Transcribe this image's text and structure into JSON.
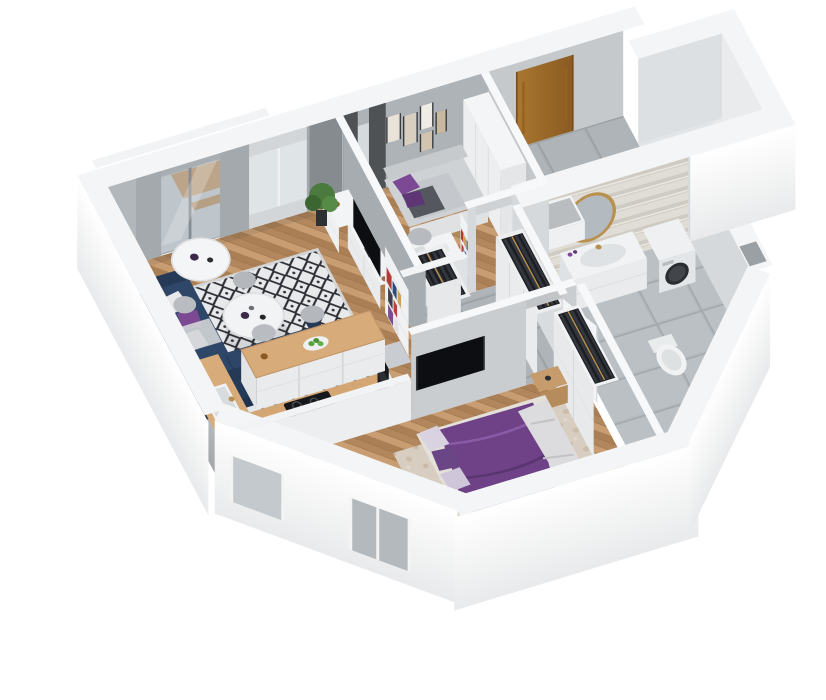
{
  "meta": {
    "title": "3D apartment floor plan - isometric cutaway render",
    "render_type": "dollhouse-cutaway",
    "background": "#ffffff"
  },
  "colors": {
    "wall-outer": "#fbfcfc",
    "wall-band": "#f4f5f6",
    "wall-gray": "#b2b7bb",
    "wall-gray-dark": "#9aa0a4",
    "wall-white": "#dcdfe1",
    "floor-wood": "#c0946a",
    "floor-wood-dark": "#ab7f55",
    "tile-blue": "#46587a",
    "tile-bg": "#e3e7ea",
    "tile-gray": "#a9afb3",
    "sofa-navy": "#2e4668",
    "sofa-navy-dark": "#253a57",
    "accent-purple": "#7c4a94",
    "accent-purple-dark": "#5e3575",
    "bed-purple": "#6f4288",
    "rug-light": "#e8e9ea",
    "rug-diamond": "#2b2e34",
    "rug-beige": "#d8cdc1",
    "door-wood": "#a9772f",
    "door-wood-dark": "#8a5a22",
    "gold": "#b8914f",
    "tv-black": "#0d0e11",
    "appliance-black": "#17181b",
    "plant-green": "#4a7a3d",
    "clothes-dark": "#23262c",
    "chevron-a": "#d8d3ca",
    "chevron-b": "#e9e6e0",
    "curtain-gray": "#868b8f",
    "curtain-dark": "#4e5255",
    "glass": "#ccd4da"
  },
  "scene": {
    "rooms": [
      {
        "name": "living-room",
        "floor": "wood-parquet",
        "furniture": [
          "corner-sofa-navy",
          "coffee-table-round",
          "dining-table-round",
          "dining-chairs",
          "rug-diamond-pattern",
          "tv-console",
          "tv",
          "bookshelf",
          "sideboard",
          "balcony-door",
          "gray-curtains",
          "plant"
        ]
      },
      {
        "name": "kitchen",
        "floor": "patterned-tile",
        "furniture": [
          "u-shaped-counter",
          "sink",
          "cooktop",
          "oven-column",
          "bar-chairs",
          "fruit-bowl",
          "half-wall"
        ]
      },
      {
        "name": "office-guest-room",
        "floor": "wood-parquet",
        "furniture": [
          "daybed-purple-pillows",
          "desk",
          "desk-chair",
          "ladder-shelf",
          "wardrobe-white",
          "gallery-wall-frames",
          "dark-curtains"
        ]
      },
      {
        "name": "entrance-hall",
        "floor": "gray-tile",
        "furniture": [
          "front-door-wood",
          "bench-with-cushion"
        ]
      },
      {
        "name": "corridor",
        "floor": "gray-tile",
        "furniture": [
          "open-closet-clothes-west",
          "open-closet-clothes-east",
          "office-door",
          "bathroom-door"
        ]
      },
      {
        "name": "bathroom",
        "floor": "gray-tile",
        "furniture": [
          "chevron-accent-wall",
          "round-gold-mirror",
          "vanity-sink",
          "washing-machine",
          "toilet"
        ]
      },
      {
        "name": "master-bedroom",
        "floor": "wood-parquet",
        "furniture": [
          "double-bed-purple-duvet",
          "white-blanket",
          "beige-rug",
          "wardrobe-clothes-rail",
          "bedside-table",
          "radiator",
          "window-sheer-curtain",
          "wall-tv",
          "plant"
        ]
      },
      {
        "name": "empty-room-wing",
        "floor": "bare",
        "furniture": []
      },
      {
        "name": "balcony",
        "floor": "gray",
        "furniture": [
          "wood-table",
          "railing"
        ]
      }
    ]
  }
}
